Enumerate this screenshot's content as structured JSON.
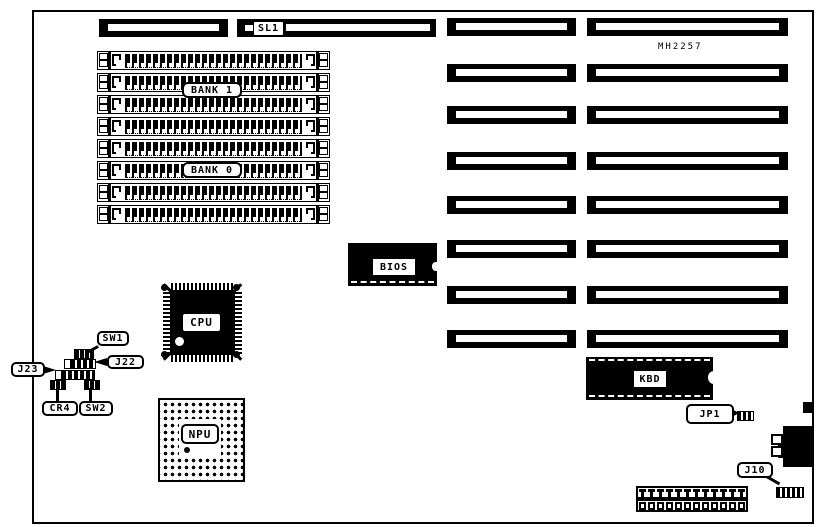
{
  "figure": {
    "kind": "motherboard layout diagram",
    "board_model": "MH2257",
    "colors": {
      "ink": "#000000",
      "paper": "#ffffff"
    }
  },
  "labels": {
    "sl1": "SL1",
    "model": "MH2257",
    "bank1": "BANK 1",
    "bank0": "BANK 0",
    "bios": "BIOS",
    "cpu": "CPU",
    "npu": "NPU",
    "kbd": "KBD",
    "sw1": "SW1",
    "j22": "J22",
    "j23": "J23",
    "cr4": "CR4",
    "sw2": "SW2",
    "jp1": "JP1",
    "j10": "J10"
  },
  "structure": {
    "simm_socket_count": 8,
    "expansion_slot_rows": 8,
    "bottom_connector_pin_count": 12
  }
}
